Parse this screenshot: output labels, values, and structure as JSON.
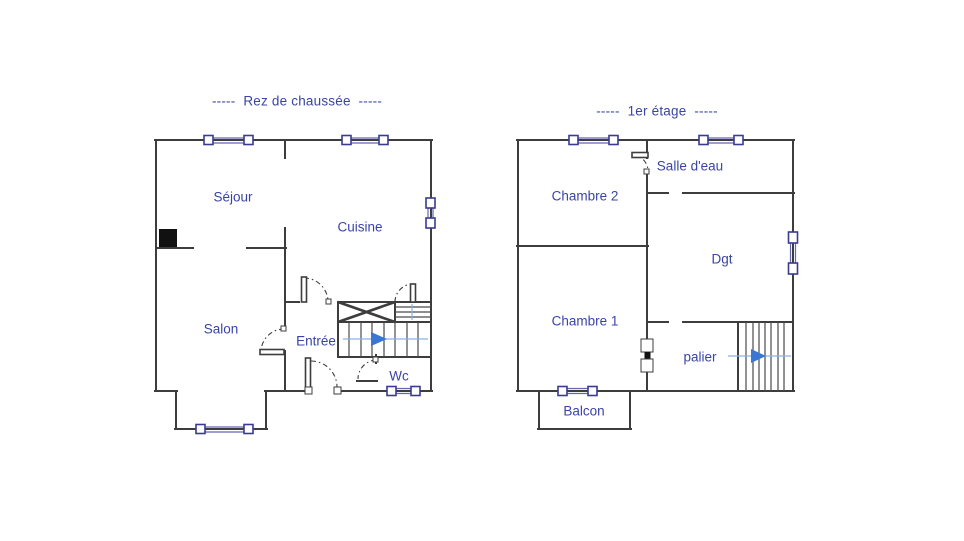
{
  "document": {
    "type": "floor-plan",
    "background": "#ffffff"
  },
  "colors": {
    "wall": "#3d3d3d",
    "accent": "#3a44a6",
    "window_frame": "#3a3a94",
    "window_glaze": "#6666b2",
    "arrow": "#3b76d4",
    "arrow_line": "#8ab0e8",
    "fireplace": "#111111",
    "tread": "#4a4a4a",
    "arcline": "#3c3c3c"
  },
  "ground_floor": {
    "title": "-----  Rez de chaussée  -----",
    "rooms": {
      "sejour": "Séjour",
      "cuisine": "Cuisine",
      "salon": "Salon",
      "entree": "Entrée",
      "wc": "Wc"
    }
  },
  "first_floor": {
    "title": "-----  1er étage  -----",
    "rooms": {
      "chambre2": "Chambre 2",
      "salle_eau": "Salle d'eau",
      "dgt": "Dgt",
      "chambre1": "Chambre 1",
      "palier": "palier",
      "balcon": "Balcon"
    }
  }
}
